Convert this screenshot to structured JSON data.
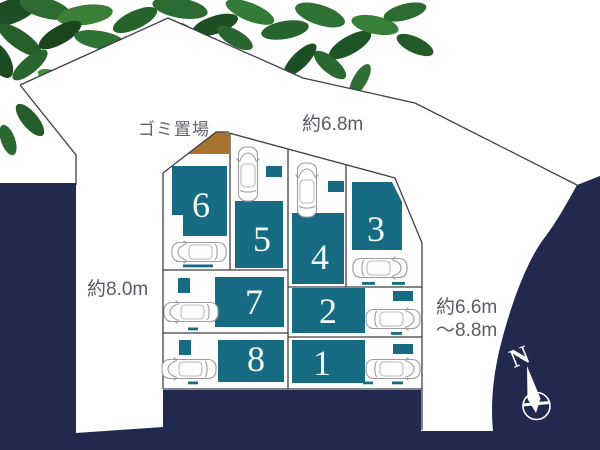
{
  "plan": {
    "type": "residential-lot-site-plan",
    "labels": {
      "garbage": "ゴミ置場",
      "dim_top": "約6.8m",
      "dim_left": "約8.0m",
      "dim_right1": "約6.6m",
      "dim_right2": "〜8.8m"
    },
    "compass": {
      "north": "N"
    },
    "lots": [
      {
        "number": "1"
      },
      {
        "number": "2"
      },
      {
        "number": "3"
      },
      {
        "number": "4"
      },
      {
        "number": "5"
      },
      {
        "number": "6"
      },
      {
        "number": "7"
      },
      {
        "number": "8"
      }
    ],
    "colors": {
      "background_navy": "#212a4e",
      "block_teal": "#176b82",
      "garbage_brown": "#a8732f",
      "boundary_line": "#3e3e46",
      "dimension_text": "#5b5b64",
      "lot_number_text": "#f2fbfa",
      "foliage_green": "#2a6830"
    }
  }
}
